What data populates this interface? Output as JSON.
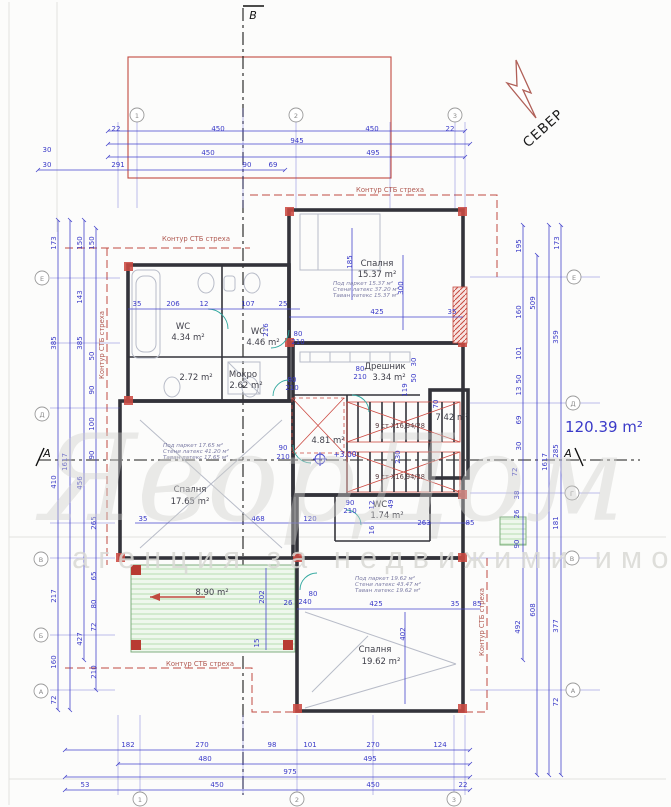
{
  "page": {
    "total_area": "120.39 m²",
    "north_label": "СЕВЕР",
    "level_mark": "+3.00",
    "watermark_big": "ЯворДом 1",
    "watermark_small": "агенция за недвижими имоти"
  },
  "labels": {
    "eave": "Контур СТБ стреха",
    "stair_flight": "9 ст X16,94/28"
  },
  "sections": {
    "top": "В",
    "left": "А",
    "right": "А"
  },
  "grid": {
    "top": [
      "1",
      "2",
      "3"
    ],
    "bottom": [
      "1",
      "2",
      "3"
    ],
    "left": [
      "Е",
      "Д",
      "В",
      "Б",
      "А"
    ],
    "right": [
      "Е",
      "Д",
      "Г",
      "В",
      "А"
    ]
  },
  "rooms": {
    "bedroom_top": {
      "name": "Спалня",
      "area": "15.37 m²",
      "notes": [
        "Под паркет 15.37 м²",
        "Стени латекс 37.20 м²",
        "Таван латекс 15.37 м²"
      ]
    },
    "wc_left": {
      "name": "WC",
      "area": "4.34 m²"
    },
    "wc_mid": {
      "name": "WC",
      "area": "4.46 m²"
    },
    "hall_left": {
      "area": "2.72 m²"
    },
    "mokro": {
      "name": "Мокро",
      "area": "2.62 m²"
    },
    "dreshnik": {
      "name": "Дрешник",
      "area": "3.34 m²"
    },
    "hall_center": {
      "area": "4.81 m²"
    },
    "room_right": {
      "area": "7.42 m²"
    },
    "bedroom_left": {
      "name": "Спалня",
      "area": "17.65 m²",
      "notes": [
        "Под паркет 17.65 м²",
        "Стени латекс 41.20 м²",
        "Таван латекс 17.65 м²"
      ]
    },
    "wc_bottom": {
      "name": "WC",
      "area": "1.74 m²"
    },
    "terrace": {
      "area": "8.90 m²"
    },
    "bedroom_bottom": {
      "name": "Спалня",
      "area": "19.62 m²",
      "notes": [
        "Под паркет 19.62 м²",
        "Стени латекс 43.47 м²",
        "Таван латекс 19.62 м²"
      ]
    }
  },
  "dim_labels": [
    {
      "t": "22",
      "x": 116,
      "y": 131
    },
    {
      "t": "450",
      "x": 218,
      "y": 131
    },
    {
      "t": "450",
      "x": 372,
      "y": 131
    },
    {
      "t": "22",
      "x": 450,
      "y": 131
    },
    {
      "t": "945",
      "x": 297,
      "y": 143
    },
    {
      "t": "30",
      "x": 47,
      "y": 152
    },
    {
      "t": "450",
      "x": 208,
      "y": 155
    },
    {
      "t": "495",
      "x": 373,
      "y": 155
    },
    {
      "t": "30",
      "x": 47,
      "y": 167
    },
    {
      "t": "291",
      "x": 118,
      "y": 167
    },
    {
      "t": "90",
      "x": 247,
      "y": 167
    },
    {
      "t": "69",
      "x": 273,
      "y": 167
    },
    {
      "t": "182",
      "x": 128,
      "y": 747
    },
    {
      "t": "270",
      "x": 202,
      "y": 747
    },
    {
      "t": "98",
      "x": 272,
      "y": 747
    },
    {
      "t": "101",
      "x": 310,
      "y": 747
    },
    {
      "t": "270",
      "x": 373,
      "y": 747
    },
    {
      "t": "124",
      "x": 440,
      "y": 747
    },
    {
      "t": "480",
      "x": 205,
      "y": 761
    },
    {
      "t": "495",
      "x": 370,
      "y": 761
    },
    {
      "t": "975",
      "x": 290,
      "y": 774
    },
    {
      "t": "53",
      "x": 85,
      "y": 787
    },
    {
      "t": "450",
      "x": 217,
      "y": 787
    },
    {
      "t": "450",
      "x": 373,
      "y": 787
    },
    {
      "t": "22",
      "x": 463,
      "y": 787
    },
    {
      "t": "173",
      "x": 56,
      "y": 243,
      "r": -90
    },
    {
      "t": "385",
      "x": 56,
      "y": 343,
      "r": -90
    },
    {
      "t": "410",
      "x": 56,
      "y": 482,
      "r": -90
    },
    {
      "t": "217",
      "x": 56,
      "y": 596,
      "r": -90
    },
    {
      "t": "160",
      "x": 56,
      "y": 662,
      "r": -90
    },
    {
      "t": "72",
      "x": 56,
      "y": 700,
      "r": -90
    },
    {
      "t": "1617",
      "x": 67,
      "y": 462,
      "r": -90
    },
    {
      "t": "150",
      "x": 82,
      "y": 243,
      "r": -90
    },
    {
      "t": "143",
      "x": 82,
      "y": 297,
      "r": -90
    },
    {
      "t": "385",
      "x": 82,
      "y": 343,
      "r": -90
    },
    {
      "t": "456",
      "x": 82,
      "y": 483,
      "r": -90
    },
    {
      "t": "427",
      "x": 82,
      "y": 639,
      "r": -90
    },
    {
      "t": "150",
      "x": 94,
      "y": 243,
      "r": -90
    },
    {
      "t": "50",
      "x": 94,
      "y": 356,
      "r": -90
    },
    {
      "t": "90",
      "x": 94,
      "y": 390,
      "r": -90
    },
    {
      "t": "100",
      "x": 94,
      "y": 424,
      "r": -90
    },
    {
      "t": "90",
      "x": 94,
      "y": 455,
      "r": -90
    },
    {
      "t": "265",
      "x": 96,
      "y": 523,
      "r": -90
    },
    {
      "t": "65",
      "x": 96,
      "y": 576,
      "r": -90
    },
    {
      "t": "80",
      "x": 96,
      "y": 604,
      "r": -90
    },
    {
      "t": "72",
      "x": 96,
      "y": 627,
      "r": -90
    },
    {
      "t": "210",
      "x": 96,
      "y": 672,
      "r": -90
    },
    {
      "t": "195",
      "x": 521,
      "y": 246,
      "r": -90
    },
    {
      "t": "160",
      "x": 521,
      "y": 312,
      "r": -90
    },
    {
      "t": "101",
      "x": 521,
      "y": 353,
      "r": -90
    },
    {
      "t": "50",
      "x": 521,
      "y": 379,
      "r": -90
    },
    {
      "t": "13",
      "x": 521,
      "y": 391,
      "r": -90
    },
    {
      "t": "69",
      "x": 521,
      "y": 420,
      "r": -90
    },
    {
      "t": "30",
      "x": 521,
      "y": 446,
      "r": -90
    },
    {
      "t": "72",
      "x": 517,
      "y": 472,
      "r": -90
    },
    {
      "t": "38",
      "x": 519,
      "y": 495,
      "r": -90
    },
    {
      "t": "26",
      "x": 519,
      "y": 514,
      "r": -90
    },
    {
      "t": "90",
      "x": 519,
      "y": 544,
      "r": -90
    },
    {
      "t": "492",
      "x": 520,
      "y": 627,
      "r": -90
    },
    {
      "t": "509",
      "x": 535,
      "y": 303,
      "r": -90
    },
    {
      "t": "608",
      "x": 535,
      "y": 610,
      "r": -90
    },
    {
      "t": "1617",
      "x": 547,
      "y": 462,
      "r": -90
    },
    {
      "t": "173",
      "x": 559,
      "y": 243,
      "r": -90
    },
    {
      "t": "359",
      "x": 558,
      "y": 337,
      "r": -90
    },
    {
      "t": "285",
      "x": 558,
      "y": 451,
      "r": -90
    },
    {
      "t": "181",
      "x": 558,
      "y": 523,
      "r": -90
    },
    {
      "t": "377",
      "x": 558,
      "y": 626,
      "r": -90
    },
    {
      "t": "72",
      "x": 558,
      "y": 702,
      "r": -90
    },
    {
      "t": "35",
      "x": 137,
      "y": 306
    },
    {
      "t": "206",
      "x": 173,
      "y": 306
    },
    {
      "t": "12",
      "x": 204,
      "y": 306
    },
    {
      "t": "107",
      "x": 248,
      "y": 306
    },
    {
      "t": "25",
      "x": 283,
      "y": 306
    },
    {
      "t": "216",
      "x": 268,
      "y": 330,
      "r": -90
    },
    {
      "t": "425",
      "x": 377,
      "y": 314
    },
    {
      "t": "35",
      "x": 452,
      "y": 314
    },
    {
      "t": "185",
      "x": 352,
      "y": 262,
      "r": -90
    },
    {
      "t": "300",
      "x": 403,
      "y": 288,
      "r": -90
    },
    {
      "t": "119",
      "x": 407,
      "y": 390,
      "r": -90
    },
    {
      "t": "50",
      "x": 416,
      "y": 378,
      "r": -90
    },
    {
      "t": "30",
      "x": 416,
      "y": 362,
      "r": -90
    },
    {
      "t": "70",
      "x": 438,
      "y": 404,
      "r": -90
    },
    {
      "t": "230",
      "x": 400,
      "y": 457,
      "r": -90
    },
    {
      "t": "49",
      "x": 393,
      "y": 504,
      "r": -90
    },
    {
      "t": "16",
      "x": 374,
      "y": 530,
      "r": -90
    },
    {
      "t": "12",
      "x": 374,
      "y": 505,
      "r": -90
    },
    {
      "t": "90",
      "x": 283,
      "y": 450
    },
    {
      "t": "210",
      "x": 283,
      "y": 459
    },
    {
      "t": "80",
      "x": 298,
      "y": 336
    },
    {
      "t": "210",
      "x": 298,
      "y": 344
    },
    {
      "t": "80",
      "x": 292,
      "y": 382
    },
    {
      "t": "210",
      "x": 292,
      "y": 390
    },
    {
      "t": "80",
      "x": 360,
      "y": 371
    },
    {
      "t": "210",
      "x": 360,
      "y": 379
    },
    {
      "t": "90",
      "x": 350,
      "y": 505
    },
    {
      "t": "210",
      "x": 350,
      "y": 513
    },
    {
      "t": "80",
      "x": 313,
      "y": 596
    },
    {
      "t": "240",
      "x": 305,
      "y": 604
    },
    {
      "t": "468",
      "x": 258,
      "y": 521
    },
    {
      "t": "35",
      "x": 143,
      "y": 521
    },
    {
      "t": "120",
      "x": 310,
      "y": 521
    },
    {
      "t": "263",
      "x": 424,
      "y": 525
    },
    {
      "t": "85",
      "x": 470,
      "y": 525
    },
    {
      "t": "202",
      "x": 264,
      "y": 597,
      "r": -90
    },
    {
      "t": "15",
      "x": 259,
      "y": 643,
      "r": -90
    },
    {
      "t": "26",
      "x": 288,
      "y": 605
    },
    {
      "t": "425",
      "x": 376,
      "y": 606
    },
    {
      "t": "35",
      "x": 455,
      "y": 606
    },
    {
      "t": "85",
      "x": 477,
      "y": 606
    },
    {
      "t": "402",
      "x": 405,
      "y": 634,
      "r": -90
    }
  ]
}
